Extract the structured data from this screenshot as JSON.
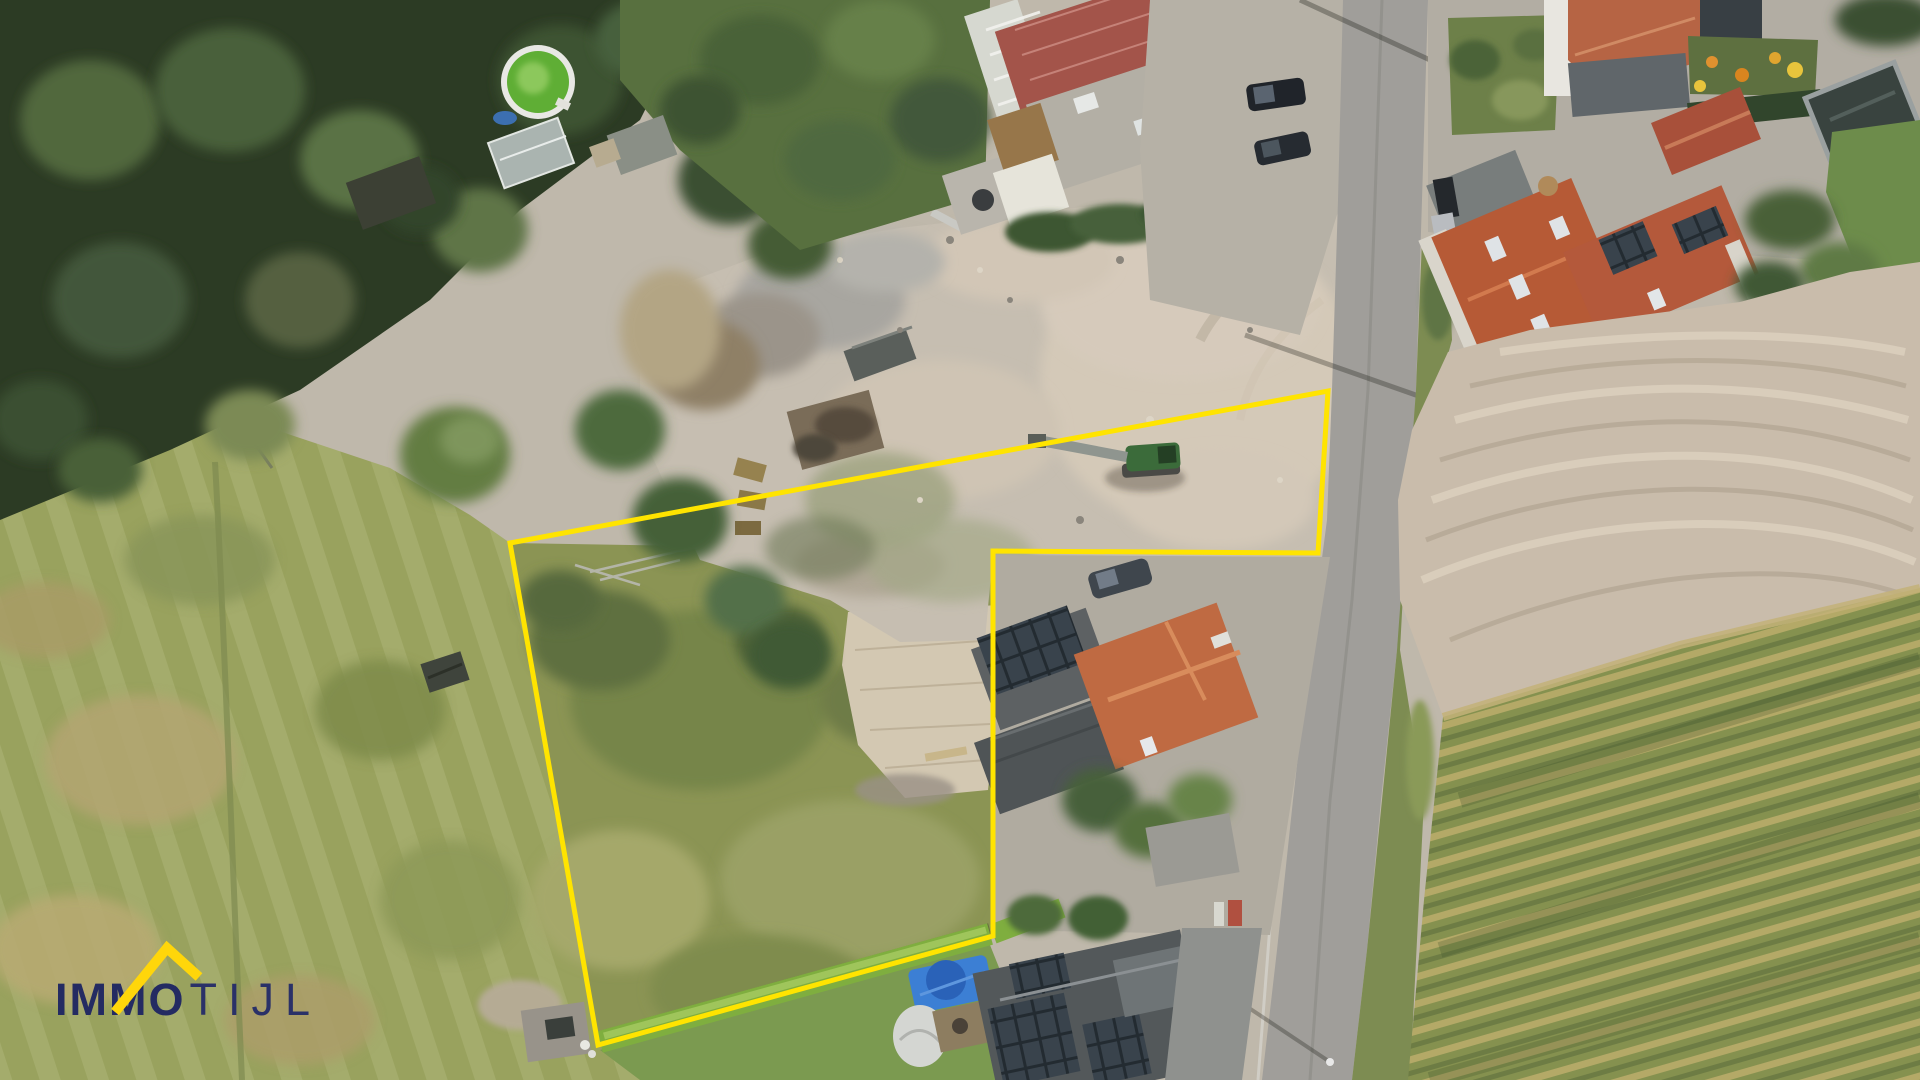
{
  "watermark": {
    "brand_bold": "IMMO",
    "brand_light": "TIJL",
    "navy": "#242b62",
    "yellow": "#ffd60a"
  },
  "boundary": {
    "color": "#ffe400",
    "points": "510,543 1328,391 1318,553 993,551 993,936 598,1045",
    "stroke_width": "5"
  }
}
